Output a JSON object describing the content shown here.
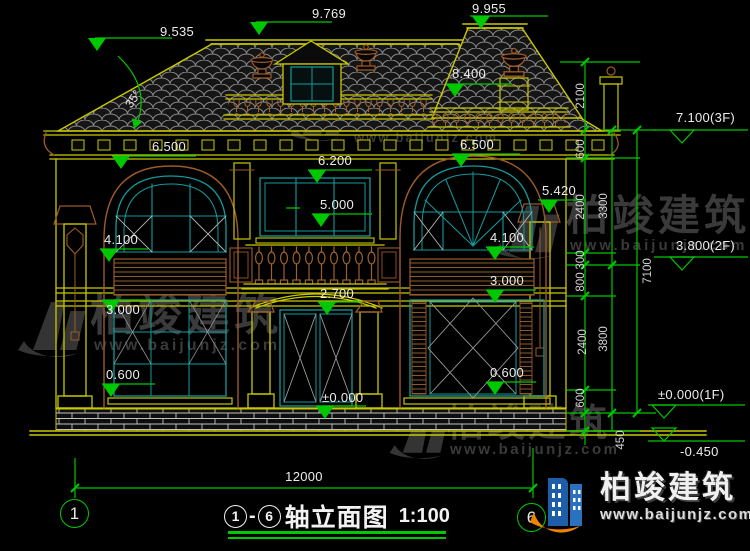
{
  "watermark": {
    "brand": "柏竣建筑",
    "url": "www.baijunjz.com"
  },
  "logo": {
    "brand": "柏竣建筑",
    "url": "www.baijunjz.com"
  },
  "angles": {
    "roof": "35°"
  },
  "levels": {
    "lv9535": "9.535",
    "lv9769": "9.769",
    "lv9955": "9.955",
    "lv8400": "8.400",
    "lv6500L": "6.500",
    "lv6500R": "6.500",
    "lv6200": "6.200",
    "lv5000": "5.000",
    "lv5420": "5.420",
    "lv4100L": "4.100",
    "lv4100R": "4.100",
    "lv3000L": "3.000",
    "lv3000R": "3.000",
    "lv0600L": "0.600",
    "lv0600R": "0.600",
    "lv2700": "2.700",
    "lv0000": "±0.000",
    "fl3": "7.100(3F)",
    "fl2": "3.800(2F)",
    "fl1": "±0.000(1F)",
    "lvm450": "-0.450"
  },
  "dims": {
    "d2100": "2100",
    "d600a": "600",
    "d2400a": "2400",
    "d300": "300",
    "d800": "800",
    "d2400b": "2400",
    "d600b": "600",
    "d450": "450",
    "d3300": "3300",
    "d3800": "3800",
    "d7100": "7100",
    "d12000": "12000"
  },
  "axes": {
    "left": "1",
    "right": "6"
  },
  "title": {
    "axis_from": "1",
    "dash": "-",
    "axis_to": "6",
    "name": "轴立面图",
    "scale": "1:100"
  },
  "colors": {
    "dim_green": "#00c800",
    "line_yellow": "#c9c900",
    "line_teal": "#129b9b",
    "line_brown": "#9c5a28",
    "logo_blue": "#1c5fa8",
    "logo_orange": "#f08300"
  }
}
